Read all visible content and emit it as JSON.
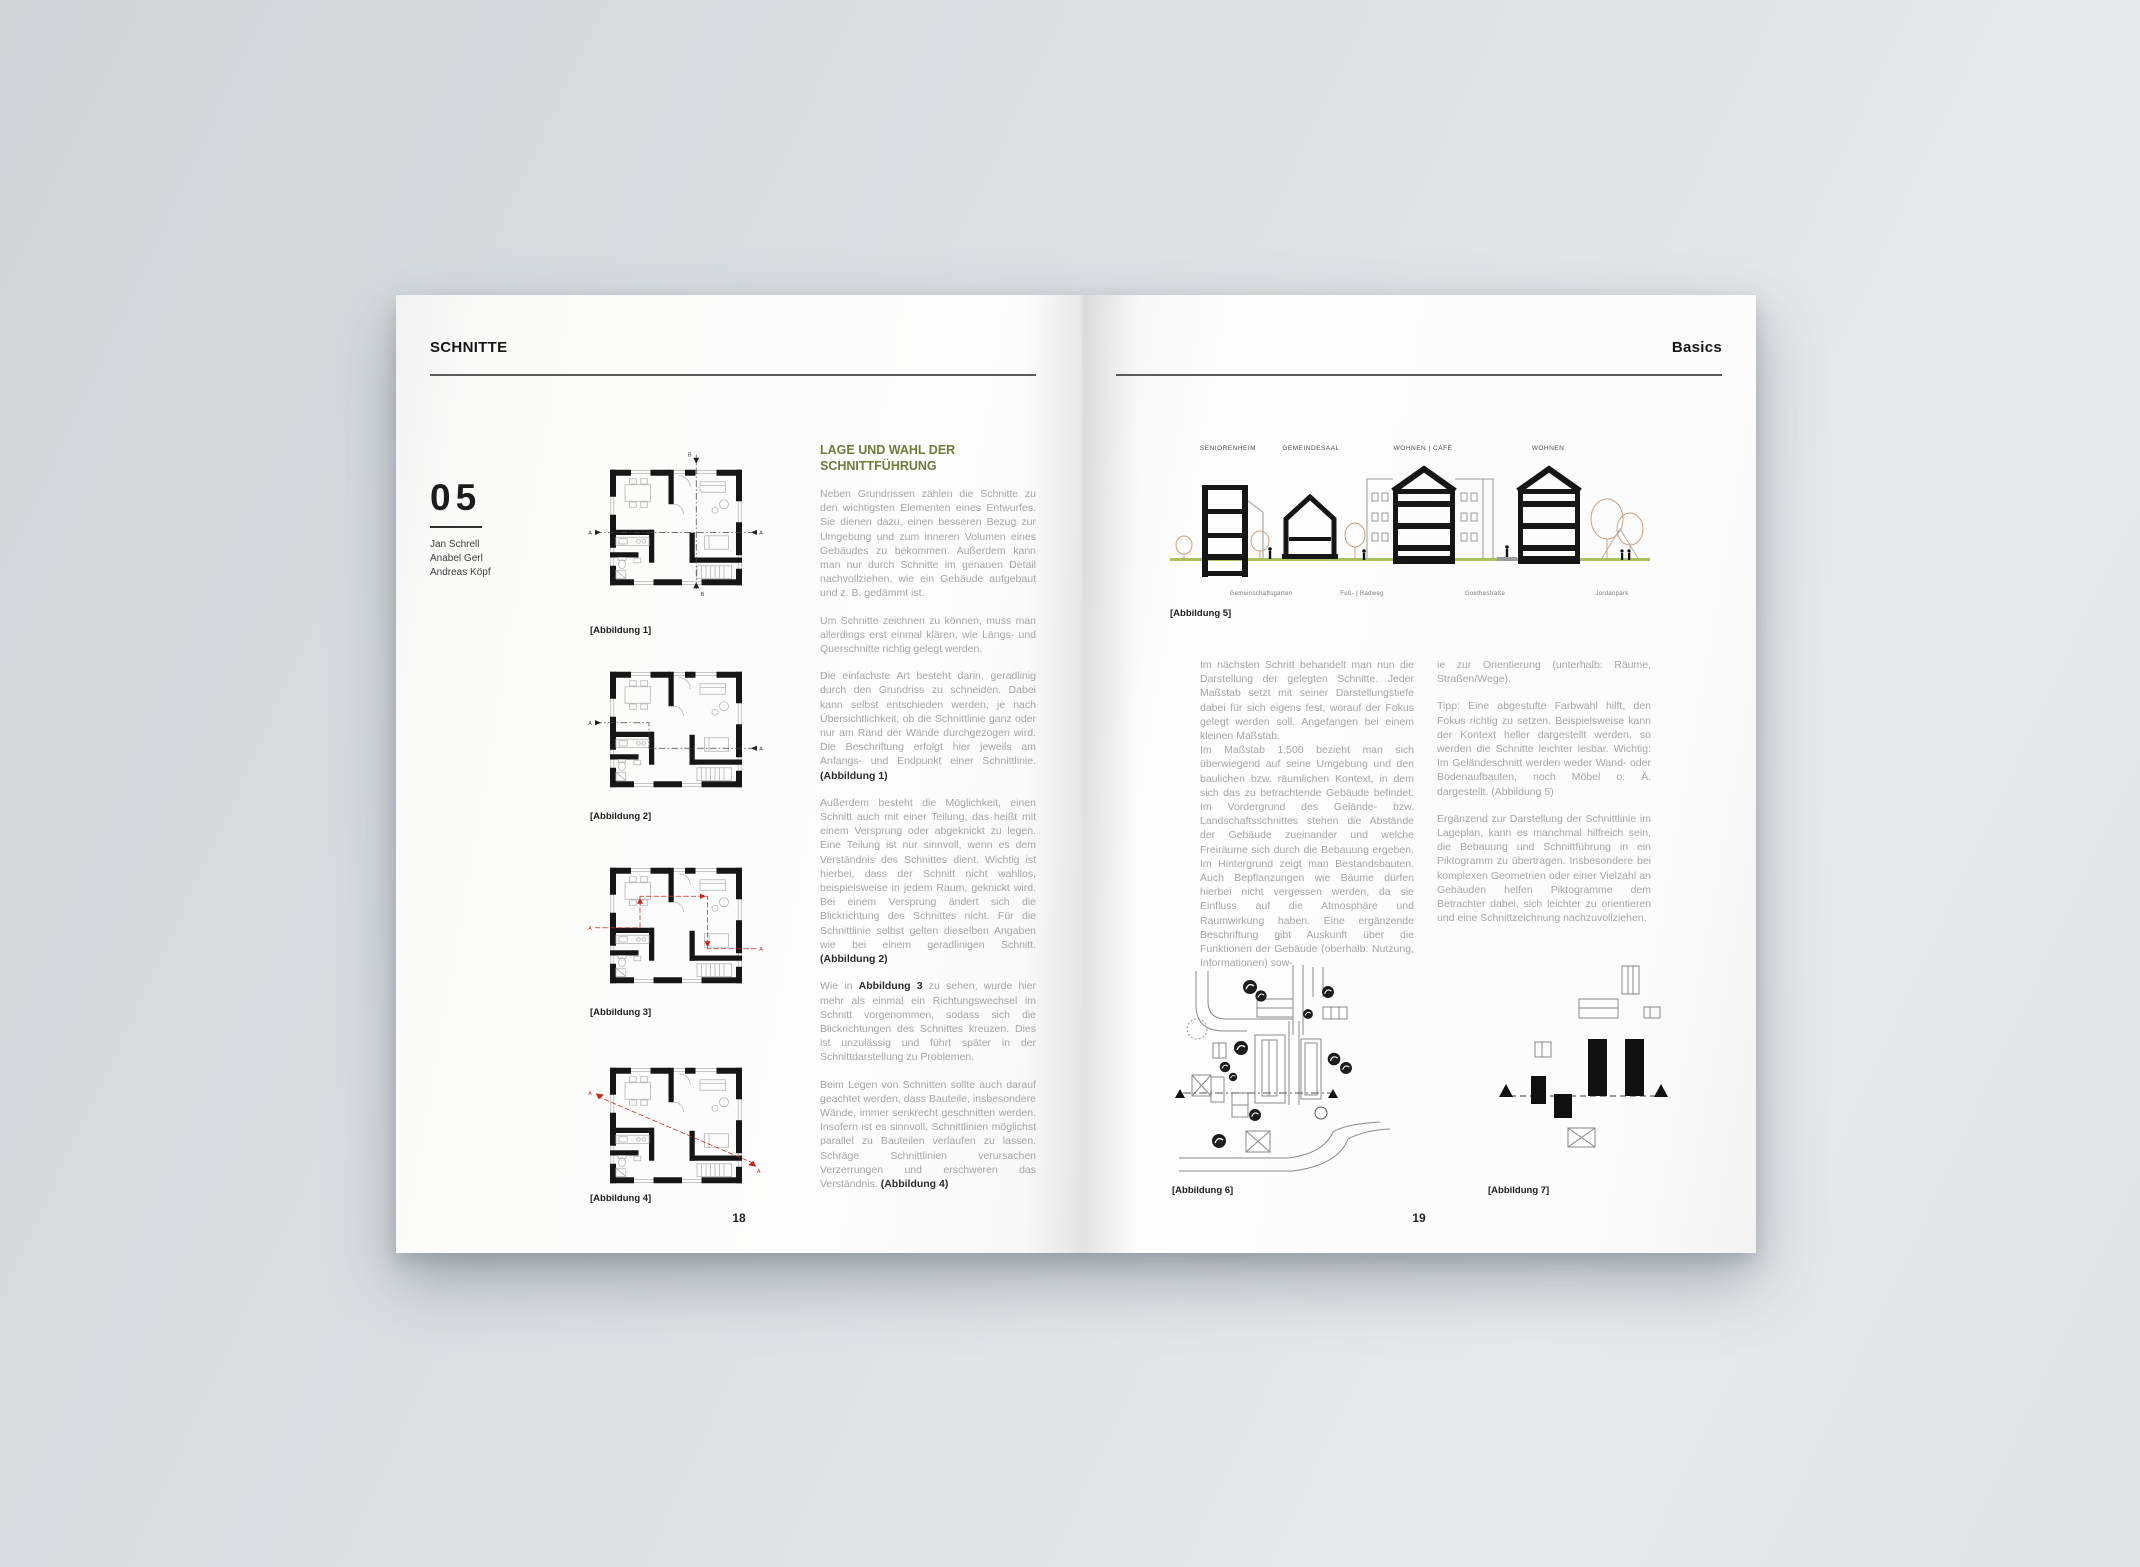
{
  "colors": {
    "accent_olive": "#6F7A3B",
    "ground_green": "#A9C25D",
    "section_red": "#C4281C",
    "tree_tan": "#C8A17B"
  },
  "markers": {
    "a": "A",
    "b": "B"
  },
  "left_page": {
    "header": "SCHNITTE",
    "chapter_number": "05",
    "authors": [
      "Jan Schrell",
      "Anabel Gerl",
      "Andreas Köpf"
    ],
    "figure_captions": [
      "[Abbildung 1]",
      "[Abbildung 2]",
      "[Abbildung 3]",
      "[Abbildung 4]"
    ],
    "article": {
      "heading": "LAGE UND WAHL DER SCHNITTFÜHRUNG",
      "p1": "Neben Grundrissen zählen die Schnitte zu den wichtigsten Elementen eines Entwurfes. Sie dienen dazu, einen besseren Bezug zur Umgebung und zum inneren Volumen eines Gebäudes zu bekommen. Außerdem kann man nur durch Schnitte im genauen Detail nachvollziehen, wie ein Gebäude aufgebaut und z. B. gedämmt ist.",
      "p2": "Um Schnitte zeichnen zu können, muss man allerdings erst einmal klären, wie Längs- und Querschnitte richtig gelegt werden.",
      "p3a": "Die einfachste Art besteht darin, geradlinig durch den Grundriss zu schneiden. Dabei kann selbst entschieden werden, je nach Übersichtlichkeit, ob die Schnittlinie ganz oder nur am Rand der Wände durchgezogen wird. Die Beschriftung erfolgt hier jeweils am Anfangs- und Endpunkt einer Schnittlinie. ",
      "p3b": "(Abbildung 1)",
      "p4a": "Außerdem besteht die Möglichkeit, einen Schnitt auch mit einer Teilung, das heißt mit einem Versprung oder abgeknickt zu legen. Eine Teilung ist nur sinnvoll, wenn es dem Verständnis des Schnittes dient. Wichtig ist hierbei, dass der Schnitt nicht wahllos, beispielsweise in jedem Raum, geknickt wird. Bei einem Versprung ändert sich die Blickrichtung des Schnittes nicht. Für die Schnittlinie selbst gelten dieselben Angaben wie bei einem geradlinigen Schnitt. ",
      "p4b": "(Abbildung 2)",
      "p5a": "Wie in ",
      "p5b": "Abbildung 3",
      "p5c": " zu sehen, wurde hier mehr als einmal ein Richtungswechsel im Schnitt vorgenommen, sodass sich die Blickrichtungen des Schnittes kreuzen. Dies ist unzulässig und führt später in der Schnittdarstellung zu Problemen.",
      "p6a": "Beim Legen von Schnitten sollte auch darauf geachtet werden, dass Bauteile, insbesondere Wände, immer senkrecht geschnitten werden. Insofern ist es sinnvoll, Schnittlinien möglichst parallel zu Bauteilen verlaufen zu lassen. Schräge Schnittlinien verursachen Verzerrungen und erschweren das Verständnis. ",
      "p6b": "(Abbildung 4)"
    },
    "page_number": "18"
  },
  "right_page": {
    "header": "Basics",
    "figure5": {
      "building_labels": [
        "SENIORENHEIM",
        "GEMEINDESAAL",
        "WOHNEN | CAFÉ",
        "WOHNEN"
      ],
      "street_labels": [
        "Gemeinschaftsgarten",
        "Fuß- | Radweg",
        "Goethestraße",
        "Jordanpark"
      ],
      "caption": "[Abbildung 5]"
    },
    "column_left": {
      "p1": "Im nächsten Schritt behandelt man nun die Darstellung der gelegten Schnitte. Jeder Maßstab setzt mit seiner Darstellungstiefe dabei für sich eigens fest, worauf der Fokus gelegt werden soll. Angefangen bei einem kleinen Maßstab.",
      "p2": "Im Maßstab 1:500 bezieht man sich überwiegend auf seine Umgebung und den baulichen bzw. räumlichen Kontext, in dem sich das zu betrachtende Gebäude befindet. Im Vordergrund des Gelände- bzw. Landschaftsschnittes stehen die Abstände der Gebäude zueinander und welche Freiräume sich durch die Bebauung ergeben. Im Hintergrund zeigt man Bestandsbauten. Auch Bepflanzungen wie Bäume dürfen hierbei nicht vergessen werden, da sie Einfluss auf die Atmosphäre und Raumwirkung haben. Eine ergänzende Beschriftung gibt Auskunft über die Funktionen der Gebäude (oberhalb: Nutzung, Informationen) sow-"
    },
    "column_right": {
      "p1": "ie zur Orientierung (unterhalb: Räume, Straßen/Wege).",
      "p2": "Tipp: Eine abgestufte Farbwahl hilft, den Fokus richtig zu setzen. Beispielsweise kann der Kontext heller dargestellt werden, so werden die Schnitte leichter lesbar. Wichtig: Im Geländeschnitt werden weder Wand- oder Bodenaufbauten, noch Möbel o. Ä. dargestellt. (Abbildung 5)",
      "p3": "Ergänzend zur Darstellung der Schnittlinie im Lageplan, kann es manchmal hilfreich sein, die Bebauung und Schnittführung in ein Piktogramm zu übertragen. Insbesondere bei komplexen Geometrien oder einer Vielzahl an Gebäuden helfen Piktogramme dem Betrachter dabei, sich leichter zu orientieren und eine Schnittzeichnung nachzuvollziehen.",
      "p4": ""
    },
    "figure6_caption": "[Abbildung 6]",
    "figure7_caption": "[Abbildung 7]",
    "page_number": "19"
  }
}
